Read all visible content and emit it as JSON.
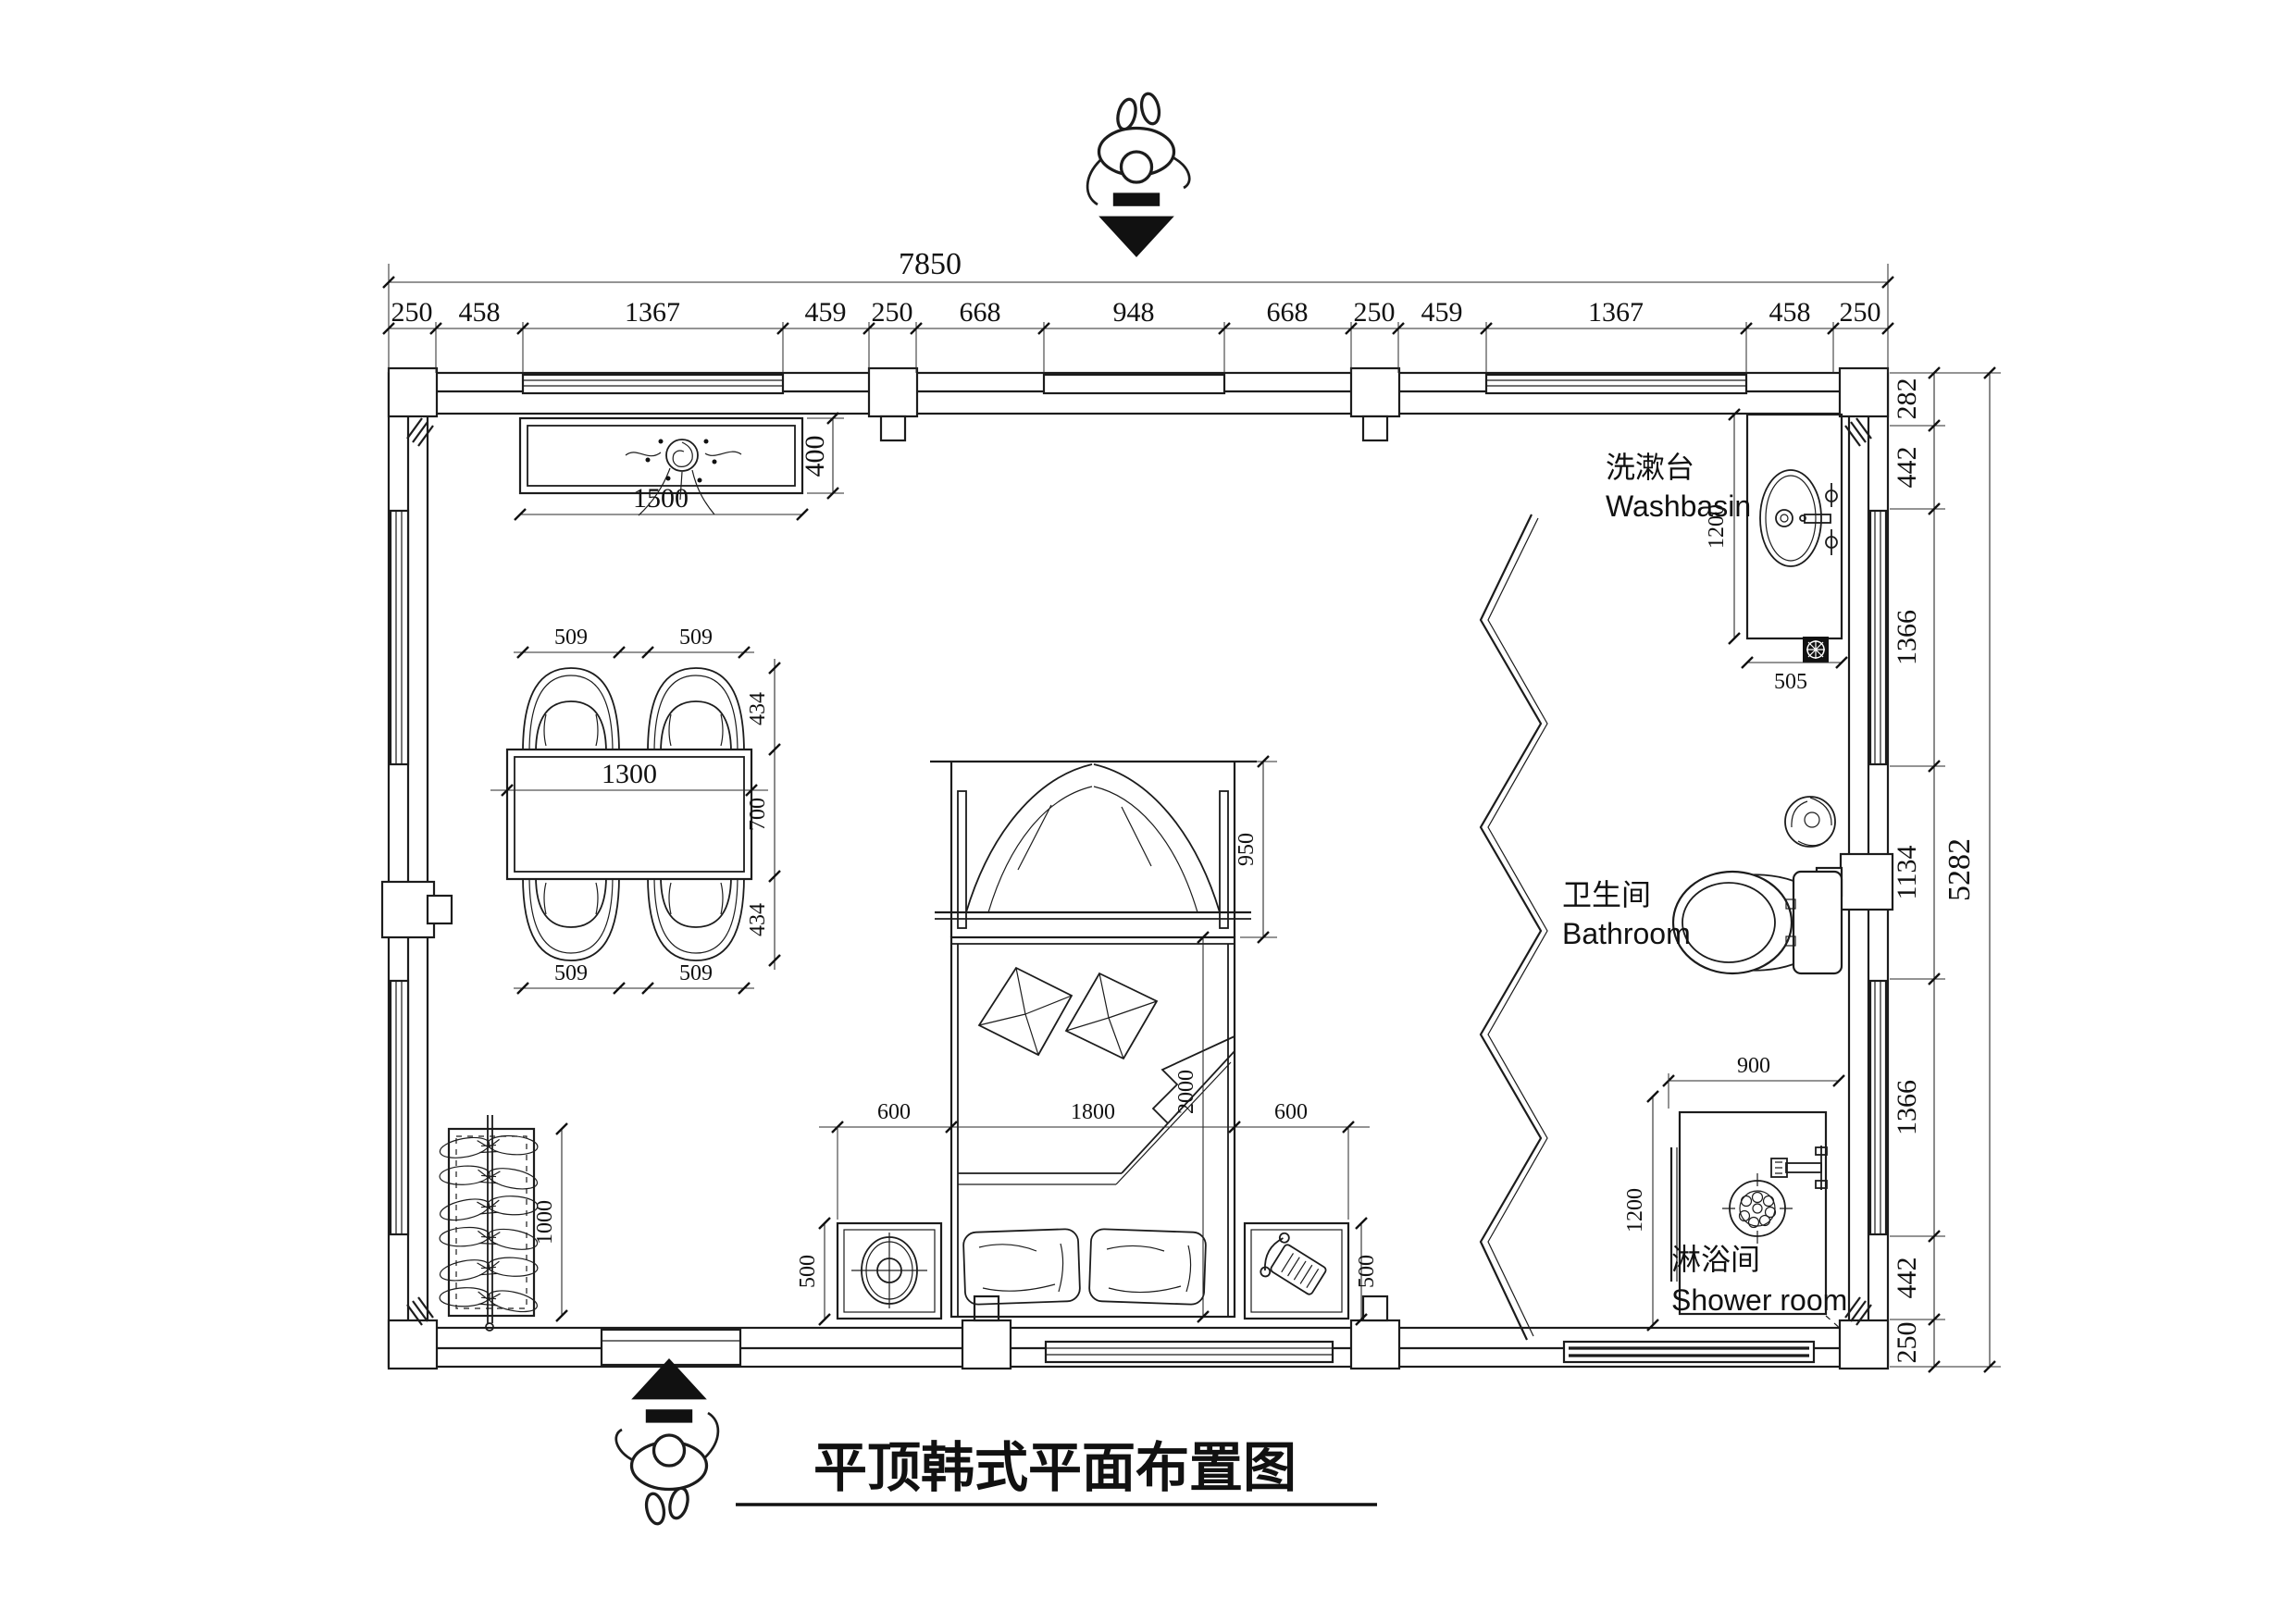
{
  "title": {
    "text": "平顶韩式平面布置图"
  },
  "dims": {
    "top_total": "7850",
    "top_chain": [
      "250",
      "458",
      "1367",
      "459",
      "250",
      "668",
      "948",
      "668",
      "250",
      "459",
      "1367",
      "458",
      "250"
    ],
    "right_chain": [
      "282",
      "442",
      "1366",
      "1134",
      "1366",
      "442",
      "250"
    ],
    "right_total": "5282"
  },
  "console": {
    "width_label": "1500",
    "depth_label": "400"
  },
  "dining": {
    "table_width": "1300",
    "chair_labels": [
      "509",
      "509",
      "509",
      "509"
    ],
    "side_labels": [
      "434",
      "700",
      "434"
    ]
  },
  "wardrobe": {
    "length_label": "1000"
  },
  "bed": {
    "bottom_chain": [
      "600",
      "1800",
      "600"
    ],
    "length_label": "2000",
    "canopy_label": "950",
    "nightstand_labels": [
      "500",
      "500"
    ]
  },
  "washbasin": {
    "label_zh": "洗漱台",
    "label_en": "Washbasin",
    "depth_label": "1200",
    "width_label": "505"
  },
  "bathroom": {
    "label_zh": "卫生间",
    "label_en": "Bathroom"
  },
  "shower": {
    "label_zh": "淋浴间",
    "label_en": "Shower room",
    "width_label": "900",
    "depth_label": "1200"
  }
}
